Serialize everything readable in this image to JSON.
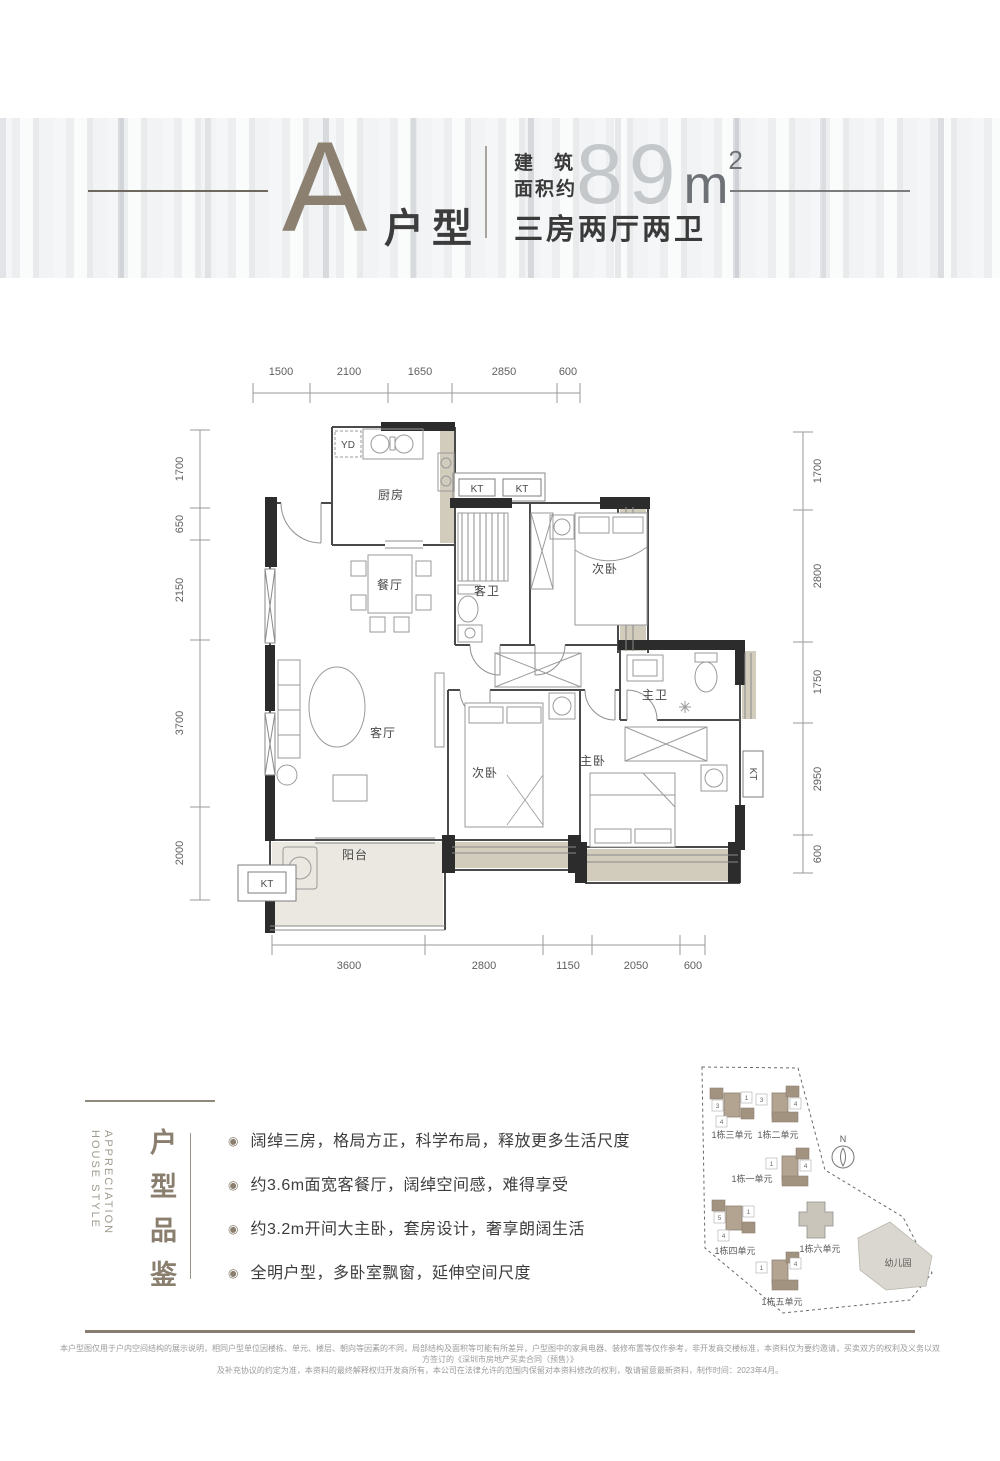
{
  "header": {
    "unit_letter": "A",
    "unit_label": "户型",
    "area_label_line1": "建筑",
    "area_label_line2": "面积约",
    "area_value": "89",
    "area_unit": "m",
    "area_exponent": "2",
    "spec": "三房两厅两卫"
  },
  "plan": {
    "rooms": {
      "kitchen": "厨房",
      "dining": "餐厅",
      "living": "客厅",
      "guest_bath": "客卫",
      "bedroom2": "次卧",
      "bedroom3": "次卧",
      "master_bedroom": "主卧",
      "master_bath": "主卫",
      "balcony": "阳台",
      "yd": "YD",
      "kt": "KT"
    },
    "dims": {
      "top": [
        "1500",
        "2100",
        "1650",
        "2850",
        "600"
      ],
      "left": [
        "1700",
        "650",
        "2150",
        "3700",
        "2000"
      ],
      "right": [
        "1700",
        "2800",
        "1750",
        "2950",
        "600"
      ],
      "bottom": [
        "3600",
        "2800",
        "1150",
        "2050",
        "600"
      ]
    }
  },
  "features": {
    "title_cn": "户型品鉴",
    "title_en_line1": "HOUSE STYLE",
    "title_en_line2": "APPRECIATION",
    "bullet": "◉",
    "items": [
      "阔绰三房，格局方正，科学布局，释放更多生活尺度",
      "约3.6m面宽客餐厅，阔绰空间感，难得享受",
      "约3.2m开间大主卧，套房设计，奢享朗阔生活",
      "全明户型，多卧室飘窗，延伸空间尺度"
    ]
  },
  "siteplan": {
    "units": [
      "1栋三单元",
      "1栋二单元",
      "1栋一单元",
      "1栋四单元",
      "1栋六单元",
      "1栋五单元"
    ],
    "cluster_units": [
      [
        "3",
        "1",
        "4"
      ],
      [
        "3",
        "4"
      ],
      [
        "1",
        "4"
      ],
      [
        "5",
        "1",
        "4"
      ],
      [
        "1",
        "4"
      ]
    ],
    "kindergarten": "幼儿园",
    "compass": "N"
  },
  "footer": {
    "line1": "本户型图仅用于户内空间结构的展示说明，相同户型单位因楼栋、单元、楼层、朝向等因素的不同，局部结构及面积等可能有所差异，户型图中的家具电器、装修布置等仅作参考，非开发商交楼标准，本资料仅为要约邀请，买卖双方的权利及义务以双方签订的《深圳市房地产买卖合同（预售）》",
    "line2": "及补充协议的约定为准，本资料的最终解释权归开发商所有，本公司在法律允许的范围内保留对本资料修改的权利，敬请留意最新资料，制作时间：2023年4月。"
  },
  "colors": {
    "accent": "#8a7e6e",
    "wall": "#2c2c2c",
    "bay_fill": "#d2ccbd",
    "floor_fill": "#eae8e0"
  }
}
